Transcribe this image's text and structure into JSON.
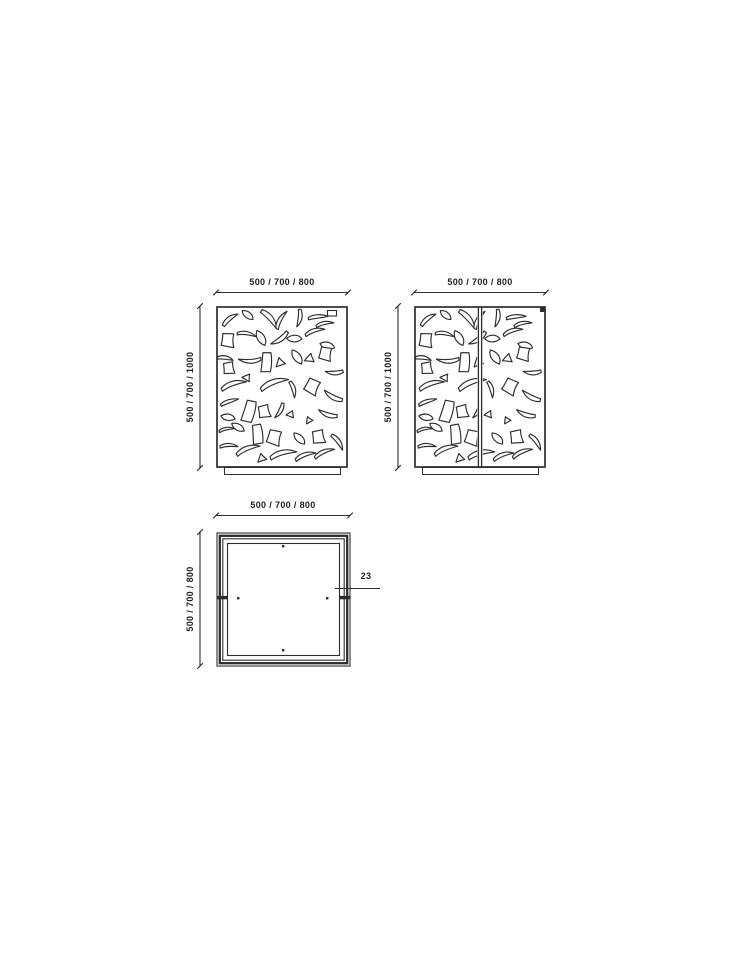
{
  "colors": {
    "line": "#2d2d2d",
    "text": "#1d1d1d",
    "background": "#ffffff"
  },
  "views": {
    "front": {
      "width_label": "500 / 700 / 800",
      "height_label": "500 / 700 / 1000"
    },
    "rear": {
      "width_label": "500 / 700 / 800",
      "height_label": "500 / 700 / 1000"
    },
    "plan": {
      "width_label": "500 / 700 / 800",
      "depth_label": "500 / 700 / 800",
      "wall_thickness_label": "23"
    }
  }
}
